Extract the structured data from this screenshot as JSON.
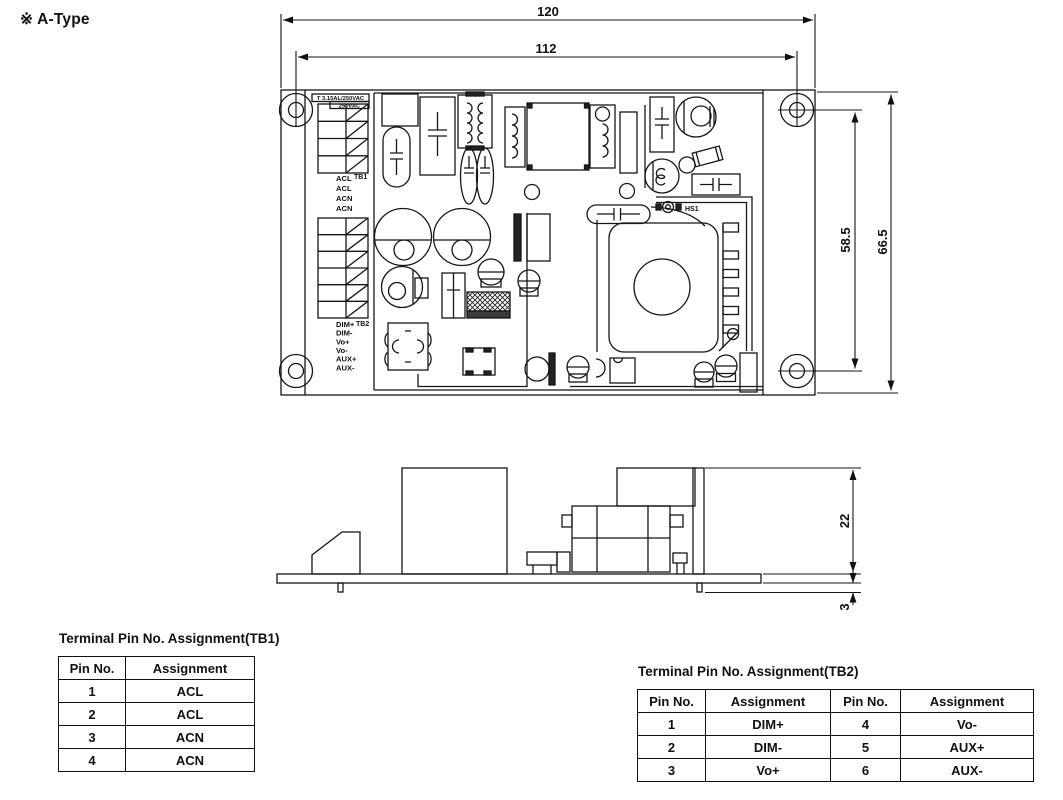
{
  "annotation": {
    "type_label": "※ A-Type"
  },
  "drawing": {
    "dimensions": {
      "board_width": "120",
      "mounting_width": "112",
      "mounting_height": "58.5",
      "board_height": "66.5",
      "component_height": "22",
      "pin_protrusion": "3"
    },
    "labels": {
      "fuse_line1": "T 3.15AL/250VAC",
      "fuse_line2": "250VAC",
      "tb1_ref": "TB1",
      "tb2_ref": "TB2",
      "heatsink": "HS1",
      "tb1_pins": [
        "ACL",
        "ACL",
        "ACN",
        "ACN"
      ],
      "tb2_pins": [
        "DIM+",
        "DIM-",
        "Vo+",
        "Vo-",
        "AUX+",
        "AUX-"
      ]
    }
  },
  "tables": {
    "tb1": {
      "title": "Terminal Pin No. Assignment(TB1)",
      "headers": [
        "Pin No.",
        "Assignment"
      ],
      "rows": [
        [
          "1",
          "ACL"
        ],
        [
          "2",
          "ACL"
        ],
        [
          "3",
          "ACN"
        ],
        [
          "4",
          "ACN"
        ]
      ]
    },
    "tb2": {
      "title": "Terminal Pin No. Assignment(TB2)",
      "headers": [
        "Pin No.",
        "Assignment",
        "Pin No.",
        "Assignment"
      ],
      "rows": [
        [
          "1",
          "DIM+",
          "4",
          "Vo-"
        ],
        [
          "2",
          "DIM-",
          "5",
          "AUX+"
        ],
        [
          "3",
          "Vo+",
          "6",
          "AUX-"
        ]
      ]
    }
  }
}
